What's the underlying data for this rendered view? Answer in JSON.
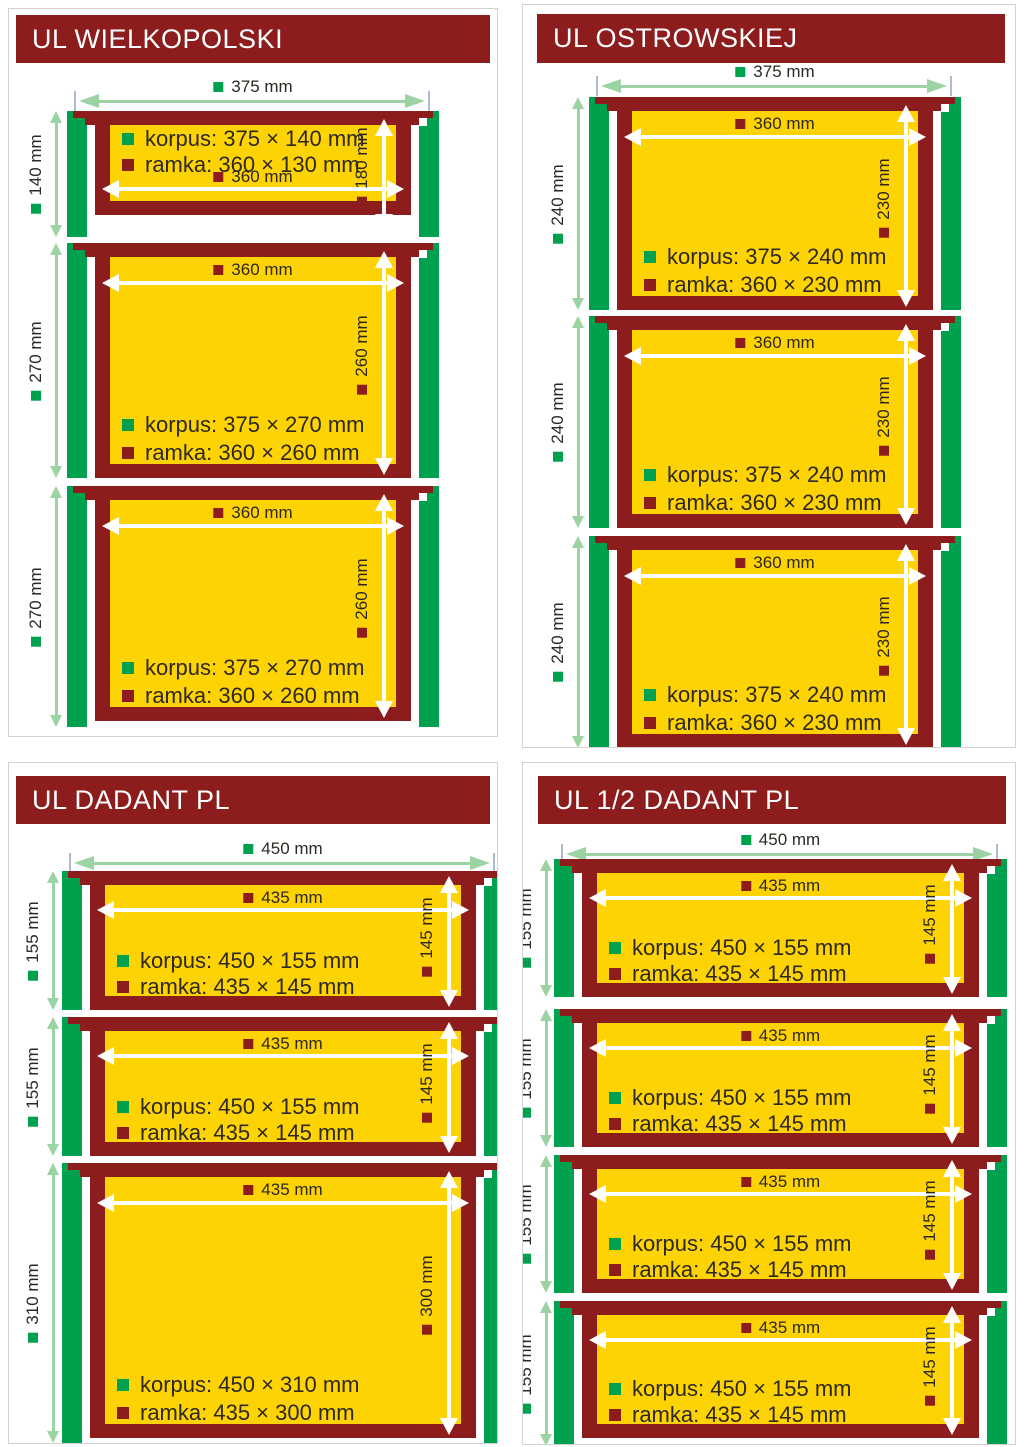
{
  "colors": {
    "maroon": "#8D1D1D",
    "yellow": "#FED304",
    "green": "#00A14E",
    "pale_green": "#9CD3A4",
    "extension_tick": "#AEBBD4",
    "text": "#2D2822",
    "panel_border": "#D2D2D2",
    "background": "#FFFFFF"
  },
  "panels": [
    {
      "title": "UL WIELKOPOLSKI",
      "top_dim": "375 mm",
      "boxes": [
        {
          "side": "140 mm",
          "width": "360 mm",
          "height": "180 mm",
          "korpus": "korpus: 375 × 140 mm",
          "ramka": "ramka: 360 × 130 mm"
        },
        {
          "side": "270 mm",
          "width": "360 mm",
          "height": "260 mm",
          "korpus": "korpus: 375 × 270 mm",
          "ramka": "ramka: 360 × 260 mm"
        },
        {
          "side": "270 mm",
          "width": "360 mm",
          "height": "260 mm",
          "korpus": "korpus: 375 × 270 mm",
          "ramka": "ramka: 360 × 260 mm"
        }
      ]
    },
    {
      "title": "UL OSTROWSKIEJ",
      "top_dim": "375 mm",
      "boxes": [
        {
          "side": "240 mm",
          "width": "360 mm",
          "height": "230 mm",
          "korpus": "korpus: 375 × 240 mm",
          "ramka": "ramka: 360 × 230 mm"
        },
        {
          "side": "240 mm",
          "width": "360 mm",
          "height": "230 mm",
          "korpus": "korpus: 375 × 240 mm",
          "ramka": "ramka: 360 × 230 mm"
        },
        {
          "side": "240 mm",
          "width": "360 mm",
          "height": "230 mm",
          "korpus": "korpus: 375 × 240 mm",
          "ramka": "ramka: 360 × 230 mm"
        }
      ]
    },
    {
      "title": "UL DADANT PL",
      "top_dim": "450 mm",
      "boxes": [
        {
          "side": "155 mm",
          "width": "435 mm",
          "height": "145 mm",
          "korpus": "korpus: 450 × 155 mm",
          "ramka": "ramka: 435 × 145 mm"
        },
        {
          "side": "155 mm",
          "width": "435 mm",
          "height": "145 mm",
          "korpus": "korpus: 450 × 155 mm",
          "ramka": "ramka: 435 × 145 mm"
        },
        {
          "side": "310 mm",
          "width": "435 mm",
          "height": "300 mm",
          "korpus": "korpus: 450 × 310 mm",
          "ramka": "ramka: 435 × 300 mm"
        }
      ]
    },
    {
      "title": "UL 1/2 DADANT PL",
      "top_dim": "450 mm",
      "boxes": [
        {
          "side": "155 mm",
          "width": "435 mm",
          "height": "145 mm",
          "korpus": "korpus: 450 × 155 mm",
          "ramka": "ramka: 435 × 145 mm"
        },
        {
          "side": "155 mm",
          "width": "435 mm",
          "height": "145 mm",
          "korpus": "korpus: 450 × 155 mm",
          "ramka": "ramka: 435 × 145 mm"
        },
        {
          "side": "155 mm",
          "width": "435 mm",
          "height": "145 mm",
          "korpus": "korpus: 450 × 155 mm",
          "ramka": "ramka: 435 × 145 mm"
        },
        {
          "side": "155 mm",
          "width": "435 mm",
          "height": "145 mm",
          "korpus": "korpus: 450 × 155 mm",
          "ramka": "ramka: 435 × 145 mm"
        }
      ]
    }
  ]
}
